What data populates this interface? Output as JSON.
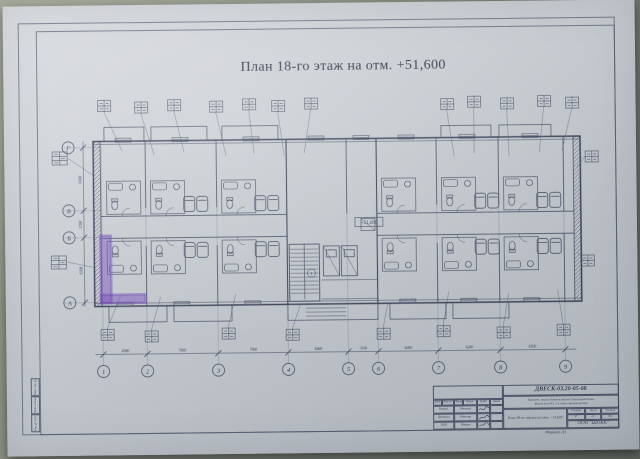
{
  "title": "План 18-го этаж на отм. +51,600",
  "elevation_mark": "+51,600",
  "axes": {
    "vertical": [
      "1",
      "2",
      "3",
      "4",
      "5",
      "6",
      "7",
      "8",
      "9"
    ],
    "horizontal": [
      "Г",
      "В",
      "Б",
      "А"
    ]
  },
  "dimensions": {
    "bottom": [
      "4380",
      "7060",
      "7060",
      "6060",
      "3190",
      "6060",
      "6240",
      "6500"
    ],
    "left": [
      "6300",
      "2700",
      "6300"
    ]
  },
  "core": {
    "stair_callout": "1"
  },
  "highlight_color": "#7a4fc3",
  "stamp": {
    "doc_code": "ДВЕСК-03.20-05-08",
    "project_line1": "Комплекс жилых домов в районе Стрелецкой балки",
    "project_line2": "Жилой дом №5. 1-й этап строительства",
    "sheet_title": "План 18-го этажа на отм. +51,600",
    "company": "ООО \"ШОКК\"",
    "stage_label": "Стадия",
    "sheet_label": "Лист",
    "sheets_label": "Листов",
    "stage": "Р",
    "sheet": "27",
    "sheets": "44",
    "header_cols": [
      "Изм.",
      "Кол.уч.",
      "Лист",
      "№док.",
      "Подп.",
      "Дата"
    ],
    "rows": [
      {
        "role": "Разраб.",
        "name": "Иванова"
      },
      {
        "role": "Проверил",
        "name": "Иванова"
      },
      {
        "role": "ГИП",
        "name": "Иванов"
      }
    ],
    "format_note": "Формат А3"
  },
  "side_stamp": [
    "Взам. инв. №",
    "Подп. и дата",
    "Инв. № подл."
  ]
}
